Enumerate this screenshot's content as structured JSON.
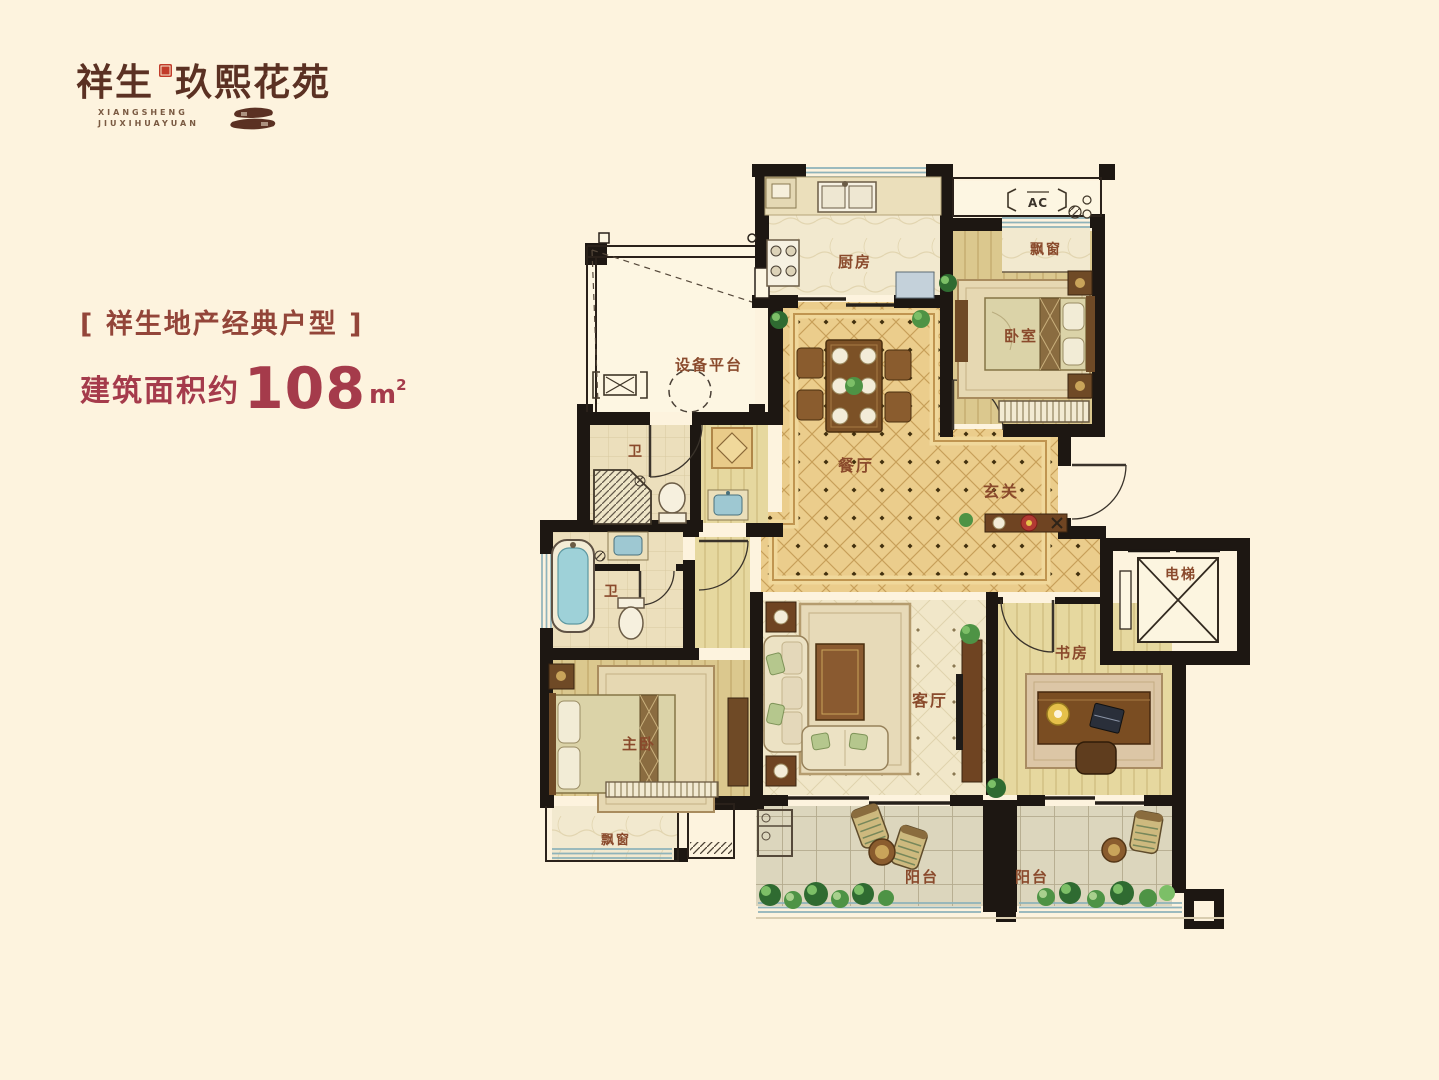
{
  "logo": {
    "brand": "祥生",
    "name": "玖熙花苑",
    "subtitle1": "XIANGSHENG",
    "subtitle2": "JIUXIHUAYUAN"
  },
  "headline": {
    "text": "[ 祥生地产经典户型 ]"
  },
  "area": {
    "prefix": "建筑面积约",
    "value": "108",
    "unit": "m",
    "power": "2"
  },
  "floorplan": {
    "labels": {
      "kitchen": "厨房",
      "equipment_platform": "设备平台",
      "bath_upper": "卫",
      "bath_lower": "卫",
      "dining": "餐厅",
      "foyer": "玄关",
      "bedroom": "卧室",
      "bay_window_top": "飘窗",
      "ac_platform": "AC",
      "elevator": "电梯",
      "living_room": "客厅",
      "study": "书房",
      "master_bedroom": "主卧",
      "bay_window_bottom": "飘窗",
      "balcony_left": "阳台",
      "balcony_right": "阳台"
    }
  },
  "colors": {
    "background": "#fdf3de",
    "headline_text": "#934539",
    "area_text": "#a53b4b",
    "logo_text": "#5b3123",
    "seal_red": "#c23b2a",
    "room_label": "#8a4a2c",
    "wall": "#1d1712",
    "dining_tile": "#ebcd8c",
    "wood_floor": "#dbc88e",
    "water_blue": "#9ed1d8",
    "plant_green": "#4e9345"
  }
}
